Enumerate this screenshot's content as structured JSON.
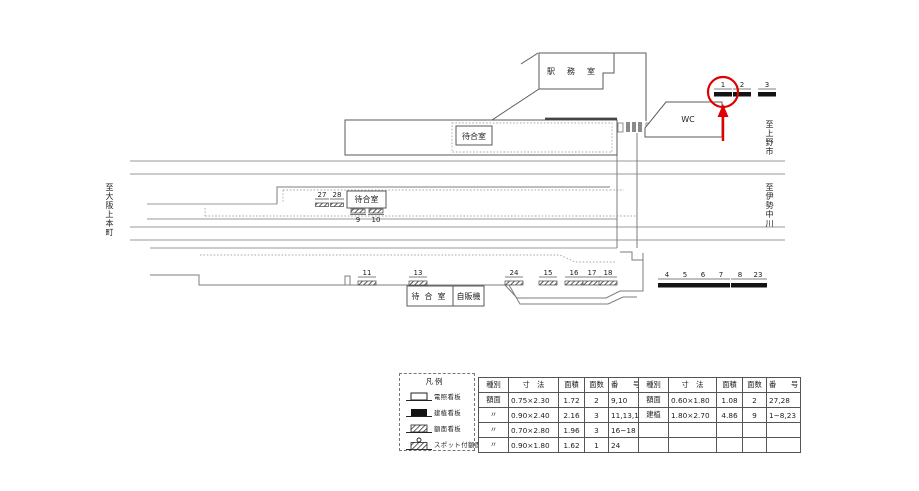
{
  "rooms": {
    "station_office": "駅務室",
    "waiting_room_upper": "待合室",
    "waiting_room_middle": "待合室",
    "waiting_room_lower": "待合室",
    "vending_machine": "自販機",
    "toilet": "WC"
  },
  "directions": {
    "left": "至大阪上本町",
    "upper_right": "至上野市",
    "lower_right": "至伊勢中川"
  },
  "sign_labels": {
    "1": "1",
    "2": "2",
    "3": "3",
    "4": "4",
    "5": "5",
    "6": "6",
    "7": "7",
    "8": "8",
    "23": "23",
    "9": "9",
    "10": "10",
    "11": "11",
    "13": "13",
    "15": "15",
    "16": "16",
    "17": "17",
    "18": "18",
    "24": "24",
    "27": "27",
    "28": "28"
  },
  "legend": {
    "title": "凡例",
    "items": [
      {
        "name": "illuminated-sign",
        "label": "電照看板"
      },
      {
        "name": "erected-sign",
        "label": "建植看板"
      },
      {
        "name": "faceplate-sign",
        "label": "額面看板"
      },
      {
        "name": "spotlit-faceplate-sign",
        "label": "スポット付額面"
      }
    ]
  },
  "tables": [
    {
      "headers": [
        "種別",
        "寸　法",
        "面積",
        "面数",
        "番　　号"
      ],
      "rows": [
        [
          "額面",
          "0.75×2.30",
          "1.72",
          "2",
          "9,10"
        ],
        [
          "〃",
          "0.90×2.40",
          "2.16",
          "3",
          "11,13,15"
        ],
        [
          "〃",
          "0.70×2.80",
          "1.96",
          "3",
          "16~18"
        ],
        [
          "〃",
          "0.90×1.80",
          "1.62",
          "1",
          "24"
        ]
      ]
    },
    {
      "headers": [
        "種別",
        "寸　法",
        "面積",
        "面数",
        "番　　号"
      ],
      "rows": [
        [
          "額面",
          "0.60×1.80",
          "1.08",
          "2",
          "27,28"
        ],
        [
          "建植",
          "1.80×2.70",
          "4.86",
          "9",
          "1~8,23"
        ],
        [
          "",
          "",
          "",
          "",
          ""
        ],
        [
          "",
          "",
          "",
          "",
          ""
        ]
      ]
    }
  ],
  "colors": {
    "annotation_red": "#e00000",
    "track_line": "#9a9a9a",
    "wall_line": "#5a5a5a",
    "sign_black": "#141414"
  }
}
